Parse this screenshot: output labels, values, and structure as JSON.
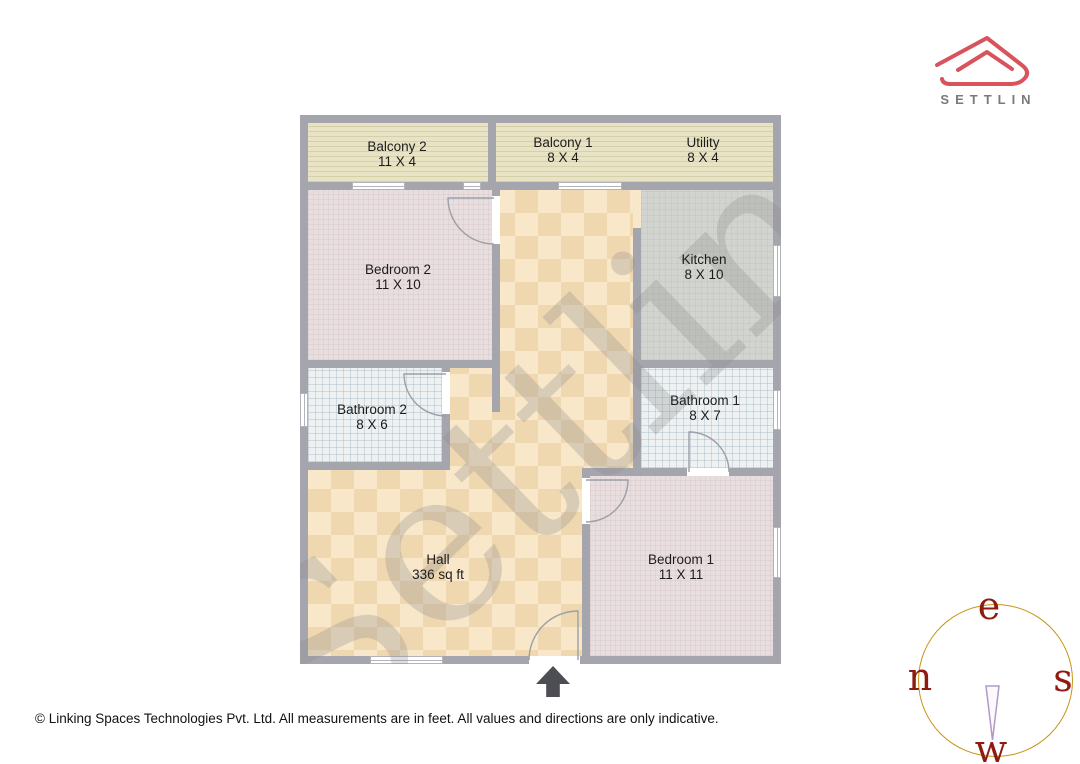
{
  "logo": {
    "brand": "SETTLIN",
    "mark_color": "#d8535b",
    "text_color": "#7a7a7a"
  },
  "floorplan": {
    "watermark": "Settlin",
    "rooms": [
      {
        "id": "balcony-2",
        "name": "Balcony 2",
        "dims": "11 X 4"
      },
      {
        "id": "balcony-1",
        "name": "Balcony 1",
        "dims": "8 X 4"
      },
      {
        "id": "utility",
        "name": "Utility",
        "dims": "8 X 4"
      },
      {
        "id": "bedroom-2",
        "name": "Bedroom 2",
        "dims": "11 X 10"
      },
      {
        "id": "kitchen",
        "name": "Kitchen",
        "dims": "8 X 10"
      },
      {
        "id": "bathroom-2",
        "name": "Bathroom 2",
        "dims": "8 X 6"
      },
      {
        "id": "bathroom-1",
        "name": "Bathroom 1",
        "dims": "8 X 7"
      },
      {
        "id": "hall",
        "name": "Hall",
        "dims": "336 sq ft"
      },
      {
        "id": "bedroom-1",
        "name": "Bedroom 1",
        "dims": "11 X 11"
      }
    ],
    "colors": {
      "wall": "#a5a5ad",
      "hall_floor": "#f8e7c9",
      "bedroom_floor": "#e9dedf",
      "kitchen_floor": "#d2d5cf",
      "bathroom_floor": "#eef1f2",
      "balcony_floor": "#e7e3c4"
    }
  },
  "compass": {
    "top": "e",
    "left": "n",
    "right": "s",
    "bottom": "w",
    "ring_color": "#c8940f",
    "letter_color": "#8e1a10",
    "needle_color": "#b19ac8"
  },
  "footer": {
    "copyright": "© Linking Spaces Technologies Pvt. Ltd. All measurements are in feet. All values and directions are only indicative."
  }
}
